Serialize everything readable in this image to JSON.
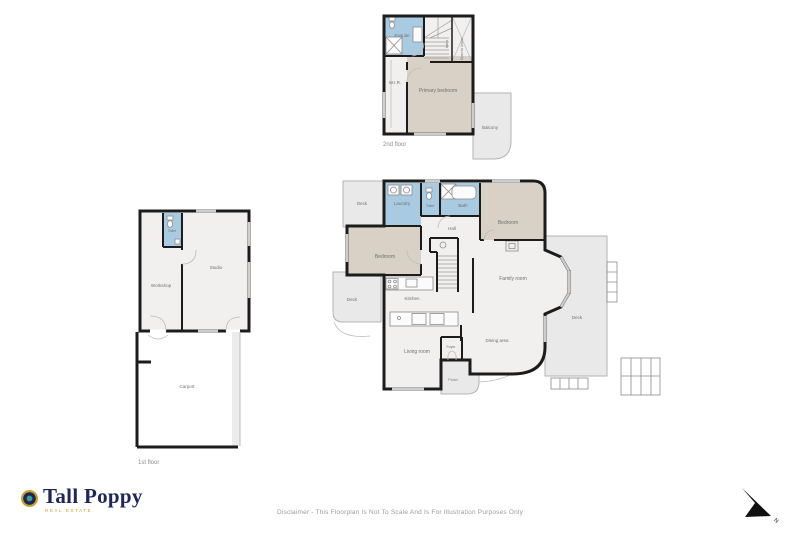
{
  "document": {
    "background": "#ffffff"
  },
  "branding": {
    "name": "Tall Poppy",
    "tagline": "REAL ESTATE"
  },
  "footer": {
    "disclaimer": "Disclaimer - This Floorplan Is Not To Scale And Is For Illustration Purposes Only"
  },
  "compass": {
    "label": "N"
  },
  "colors": {
    "wall": "#1c1c1c",
    "wet_room": "#a9cbe2",
    "bedroom": "#d9d1c5",
    "room": "#f1f0ef",
    "deck": "#e9e9e9",
    "logo_navy": "#1e2757",
    "logo_gold": "#c9a227",
    "logo_teal": "#3a9f8d",
    "label_text": "#6f6f6f"
  },
  "floors": {
    "second": {
      "label": "2nd floor",
      "rooms": {
        "ensuite": "Ensuite",
        "stairs": "stairs",
        "open_to_below": "Open to below",
        "wir": "W.I.R.",
        "primary_bedroom": "Primary bedroom",
        "balcony": "Balcony"
      }
    },
    "main": {
      "rooms": {
        "deck_top": "Deck",
        "laundry": "Laundry",
        "toilet": "Toilet",
        "bath": "Bath",
        "hall": "Hall",
        "bedroom_right": "Bedroom",
        "bedroom_left": "Bedroom",
        "kitchen": "Kitchen",
        "family_room": "Family room",
        "dining_area": "Dining area",
        "living_room": "Living room",
        "foyer": "Foyer",
        "porch": "Porch",
        "deck_left": "Deck",
        "deck_right": "Deck"
      }
    },
    "first": {
      "label": "1st floor",
      "rooms": {
        "toilet": "Toilet",
        "workshop": "Workshop",
        "studio": "Studio",
        "carport": "Carport"
      }
    }
  }
}
